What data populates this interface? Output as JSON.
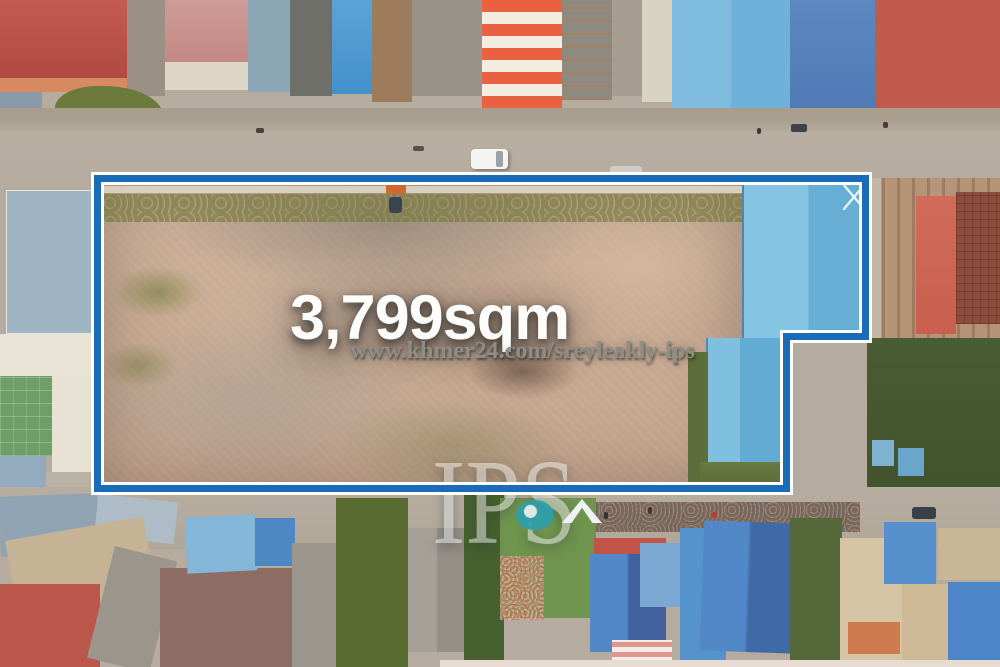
{
  "overlay": {
    "area_label": "3,799sqm",
    "listing_url": "www.khmer24.com/sreyleakly-ips",
    "brand_watermark": "IPS"
  },
  "colors": {
    "plot_outline_blue": "#1a6cb8",
    "plot_outline_white": "#ffffff",
    "area_text_white": "#fdfdfb",
    "url_text_gray": "#8f8e86",
    "brand_teal": "#2b9fae",
    "warehouse_roof_blue": "#74b9dc",
    "plot_dirt_tan": "#c8ab95"
  },
  "scene": {
    "type": "aerial-drone-photo",
    "subject": "Vacant 3,799sqm land plot outlined in blue, surrounded by shophouses with colored metal roofs, two roads and vegetation"
  }
}
